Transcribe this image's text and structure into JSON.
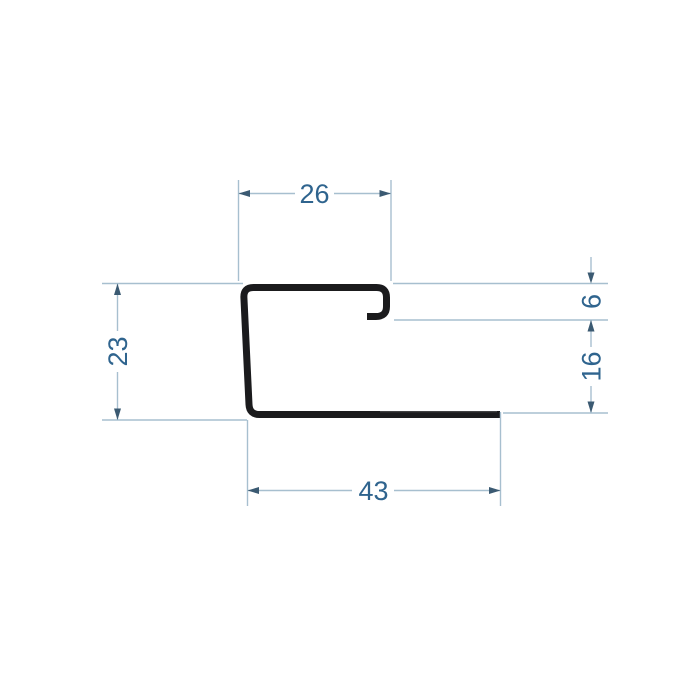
{
  "drawing": {
    "title": "J-profile cross-section technical drawing",
    "units_shown": false,
    "dimensions": {
      "top_width": "26",
      "left_height": "23",
      "hook_gap": "6",
      "right_lower_height": "16",
      "bottom_width": "43"
    },
    "colors": {
      "background": "#ffffff",
      "profile": "#1b1b1d",
      "dimline": "#a7bfcf",
      "arrow": "#3b5a72",
      "dimtext": "#2f648e"
    }
  }
}
